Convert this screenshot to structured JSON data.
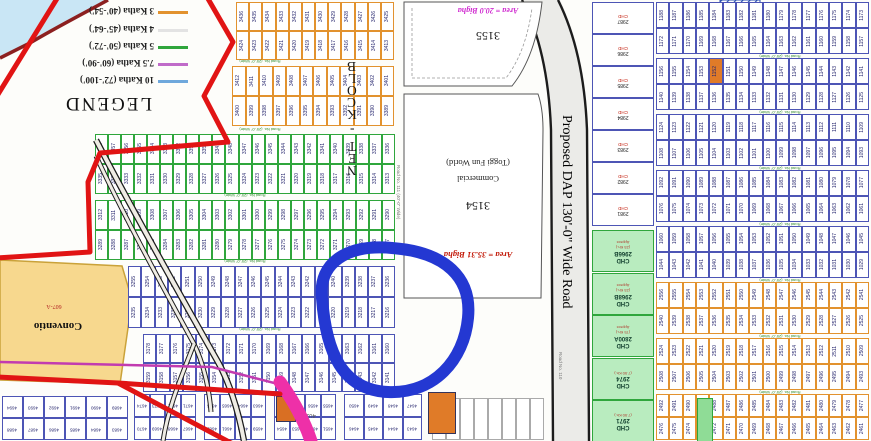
{
  "colors": {
    "boundary": "#e11414",
    "river_fill": "#c9e6f5",
    "river_edge": "#8c2020",
    "road_fill": "#ebebe8",
    "road_edge": "#1c1c1c",
    "pink_road": "#ee30a8",
    "magenta_line": "#c23bb0",
    "circle": "#2438d2",
    "orange": "#e2922e",
    "green": "#2fa63c",
    "blue": "#4d55b5",
    "purple": "#c06bc9",
    "skyblue": "#6fa8dc",
    "convention_fill": "#f7d88e",
    "convention_edge": "#caa23a",
    "highlight_orange": "#e07b28",
    "num_color": "#26266e",
    "road_label_green": "#2e8b2e"
  },
  "legend": {
    "title": "LEGEND",
    "items": [
      {
        "label": "3 Katha (40'-54')",
        "color": "#e2922e"
      },
      {
        "label": "4 Katha (45'-64')",
        "color": "#e3e3e3"
      },
      {
        "label": "5 Katha (50'-72')",
        "color": "#2fa63c"
      },
      {
        "label": "7.5 Katha (60'-90')",
        "color": "#c06bc9"
      },
      {
        "label": "10 Katha (72'-100')",
        "color": "#6fa8dc"
      }
    ]
  },
  "block": {
    "label": "BLOCK - TEN"
  },
  "main_road": {
    "label": "Proposed DAP 130'-0\" Wide Road",
    "secondary": "Road No. 110"
  },
  "parcel_3155": {
    "number": "3155",
    "area": "Area = 20.0 Bigha"
  },
  "parcel_3154": {
    "number": "3154",
    "use_line1": "(Toggi Fun World)",
    "use_line2": "Commercial",
    "area": "Area = 35.31 Bigha"
  },
  "side_road_111": {
    "label": "Road No. 111 (40'-0\" Wide)"
  },
  "convention": {
    "label": "Conventio",
    "code": "607-A"
  },
  "bottom_labels": {
    "plot_4020": "4020"
  },
  "cross_road_label": "Road No. (25'-0\" Wide)",
  "left_grid": {
    "bands": [
      {
        "x": 236,
        "y": 2,
        "w": 158,
        "h": 58,
        "color": "orange",
        "rows": [
          {
            "from": 3436,
            "to": 3425
          },
          {
            "from": 3424,
            "to": 3413
          }
        ]
      },
      {
        "x": 232,
        "y": 66,
        "w": 162,
        "h": 60,
        "color": "orange",
        "rows": [
          {
            "from": 3412,
            "to": 3401
          },
          {
            "from": 3400,
            "to": 3389
          }
        ]
      },
      {
        "x": 95,
        "y": 134,
        "w": 300,
        "h": 60,
        "color": "green",
        "rows": [
          {
            "from": 3358,
            "to": 3336
          },
          {
            "from": 3335,
            "to": 3313
          }
        ]
      },
      {
        "x": 95,
        "y": 200,
        "w": 300,
        "h": 60,
        "color": "green",
        "rows": [
          {
            "from": 3312,
            "to": 3290
          },
          {
            "from": 3289,
            "to": 3267
          }
        ]
      },
      {
        "x": 128,
        "y": 266,
        "w": 267,
        "h": 62,
        "color": "blue",
        "rows": [
          {
            "from": 3255,
            "to": 3236
          },
          {
            "from": 3235,
            "to": 3216
          }
        ]
      },
      {
        "x": 143,
        "y": 334,
        "w": 252,
        "h": 58,
        "color": "blue",
        "rows": [
          {
            "from": 3178,
            "to": 3160
          },
          {
            "from": 3159,
            "to": 3141
          }
        ]
      }
    ]
  },
  "right_grid": {
    "bands": [
      {
        "x": 656,
        "y": 2,
        "w": 213,
        "h": 52,
        "color": "blue",
        "rows": [
          {
            "from": 1188,
            "to": 1173
          },
          {
            "from": 1172,
            "to": 1157
          }
        ]
      },
      {
        "x": 656,
        "y": 58,
        "w": 213,
        "h": 52,
        "color": "blue",
        "rows": [
          {
            "from": 1156,
            "to": 1141
          },
          {
            "from": 1140,
            "to": 1125
          }
        ],
        "highlight": [
          0,
          4
        ]
      },
      {
        "x": 656,
        "y": 114,
        "w": 213,
        "h": 52,
        "color": "blue",
        "rows": [
          {
            "from": 1124,
            "to": 1109
          },
          {
            "from": 1108,
            "to": 1093
          }
        ]
      },
      {
        "x": 656,
        "y": 170,
        "w": 213,
        "h": 52,
        "color": "blue",
        "rows": [
          {
            "from": 1092,
            "to": 1077
          },
          {
            "from": 1076,
            "to": 1061
          }
        ]
      },
      {
        "x": 656,
        "y": 226,
        "w": 213,
        "h": 52,
        "color": "blue",
        "rows": [
          {
            "from": 1060,
            "to": 1045
          },
          {
            "from": 1044,
            "to": 1029
          }
        ]
      },
      {
        "x": 656,
        "y": 282,
        "w": 213,
        "h": 52,
        "color": "orange",
        "rows": [
          {
            "from": 2556,
            "to": 2541
          },
          {
            "from": 2540,
            "to": 2525
          }
        ]
      },
      {
        "x": 656,
        "y": 338,
        "w": 213,
        "h": 52,
        "color": "orange",
        "rows": [
          {
            "from": 2524,
            "to": 2509
          },
          {
            "from": 2508,
            "to": 2493
          }
        ]
      },
      {
        "x": 656,
        "y": 394,
        "w": 213,
        "h": 46,
        "color": "orange",
        "rows": [
          {
            "from": 2492,
            "to": 2477
          },
          {
            "from": 2476,
            "to": 2461
          }
        ]
      }
    ]
  },
  "chd_column": {
    "top_cells": [
      {
        "num": "2987",
        "code": "CHD"
      },
      {
        "num": "2986",
        "code": "CHD"
      },
      {
        "num": "2985",
        "code": "CHD"
      },
      {
        "num": "2984",
        "code": "CHD"
      },
      {
        "num": "2983",
        "code": "CHD"
      },
      {
        "num": "2982",
        "code": "CHD"
      },
      {
        "num": "2981",
        "code": "CHD"
      }
    ],
    "green_blocks": [
      {
        "name": "CHD",
        "num": "2966B",
        "sub": "(23 Kh.)",
        "sub2": "Approx"
      },
      {
        "name": "CHD",
        "num": "2968B",
        "sub": "(23 Kh.)",
        "sub2": "Approx"
      },
      {
        "name": "CHD",
        "num": "2800A",
        "sub": "(75 Kh.)",
        "sub2": "Approx"
      },
      {
        "name": "CHD",
        "num": "2974",
        "sub": "(7.50 Kh.)",
        "sub2": ""
      },
      {
        "name": "CHD",
        "num": "2971",
        "sub": "(7.50 Kh.)",
        "sub2": ""
      }
    ]
  },
  "bottom_strip": {
    "groups": [
      {
        "x": 2,
        "y": 396,
        "w": 126,
        "h": 44,
        "color": "blue",
        "rows": [
          {
            "from": 4694,
            "to": 4689
          },
          {
            "from": 4688,
            "to": 4683
          }
        ]
      },
      {
        "x": 134,
        "y": 394,
        "w": 62,
        "h": 46,
        "color": "blue",
        "rows": [
          {
            "from": 4674,
            "to": 4671
          },
          {
            "from": 4670,
            "to": 4667
          }
        ]
      },
      {
        "x": 204,
        "y": 394,
        "w": 62,
        "h": 46,
        "color": "blue",
        "rows": [
          {
            "from": 4666,
            "to": 4663
          },
          {
            "from": 4662,
            "to": 4659
          }
        ]
      },
      {
        "x": 274,
        "y": 394,
        "w": 62,
        "h": 46,
        "color": "blue",
        "rows": [
          {
            "from": 4658,
            "to": 4655
          },
          {
            "from": 4654,
            "to": 4651
          }
        ]
      },
      {
        "x": 344,
        "y": 394,
        "w": 78,
        "h": 46,
        "color": "blue",
        "rows": [
          {
            "from": 4650,
            "to": 4647
          },
          {
            "from": 4646,
            "to": 4643
          }
        ]
      }
    ]
  }
}
